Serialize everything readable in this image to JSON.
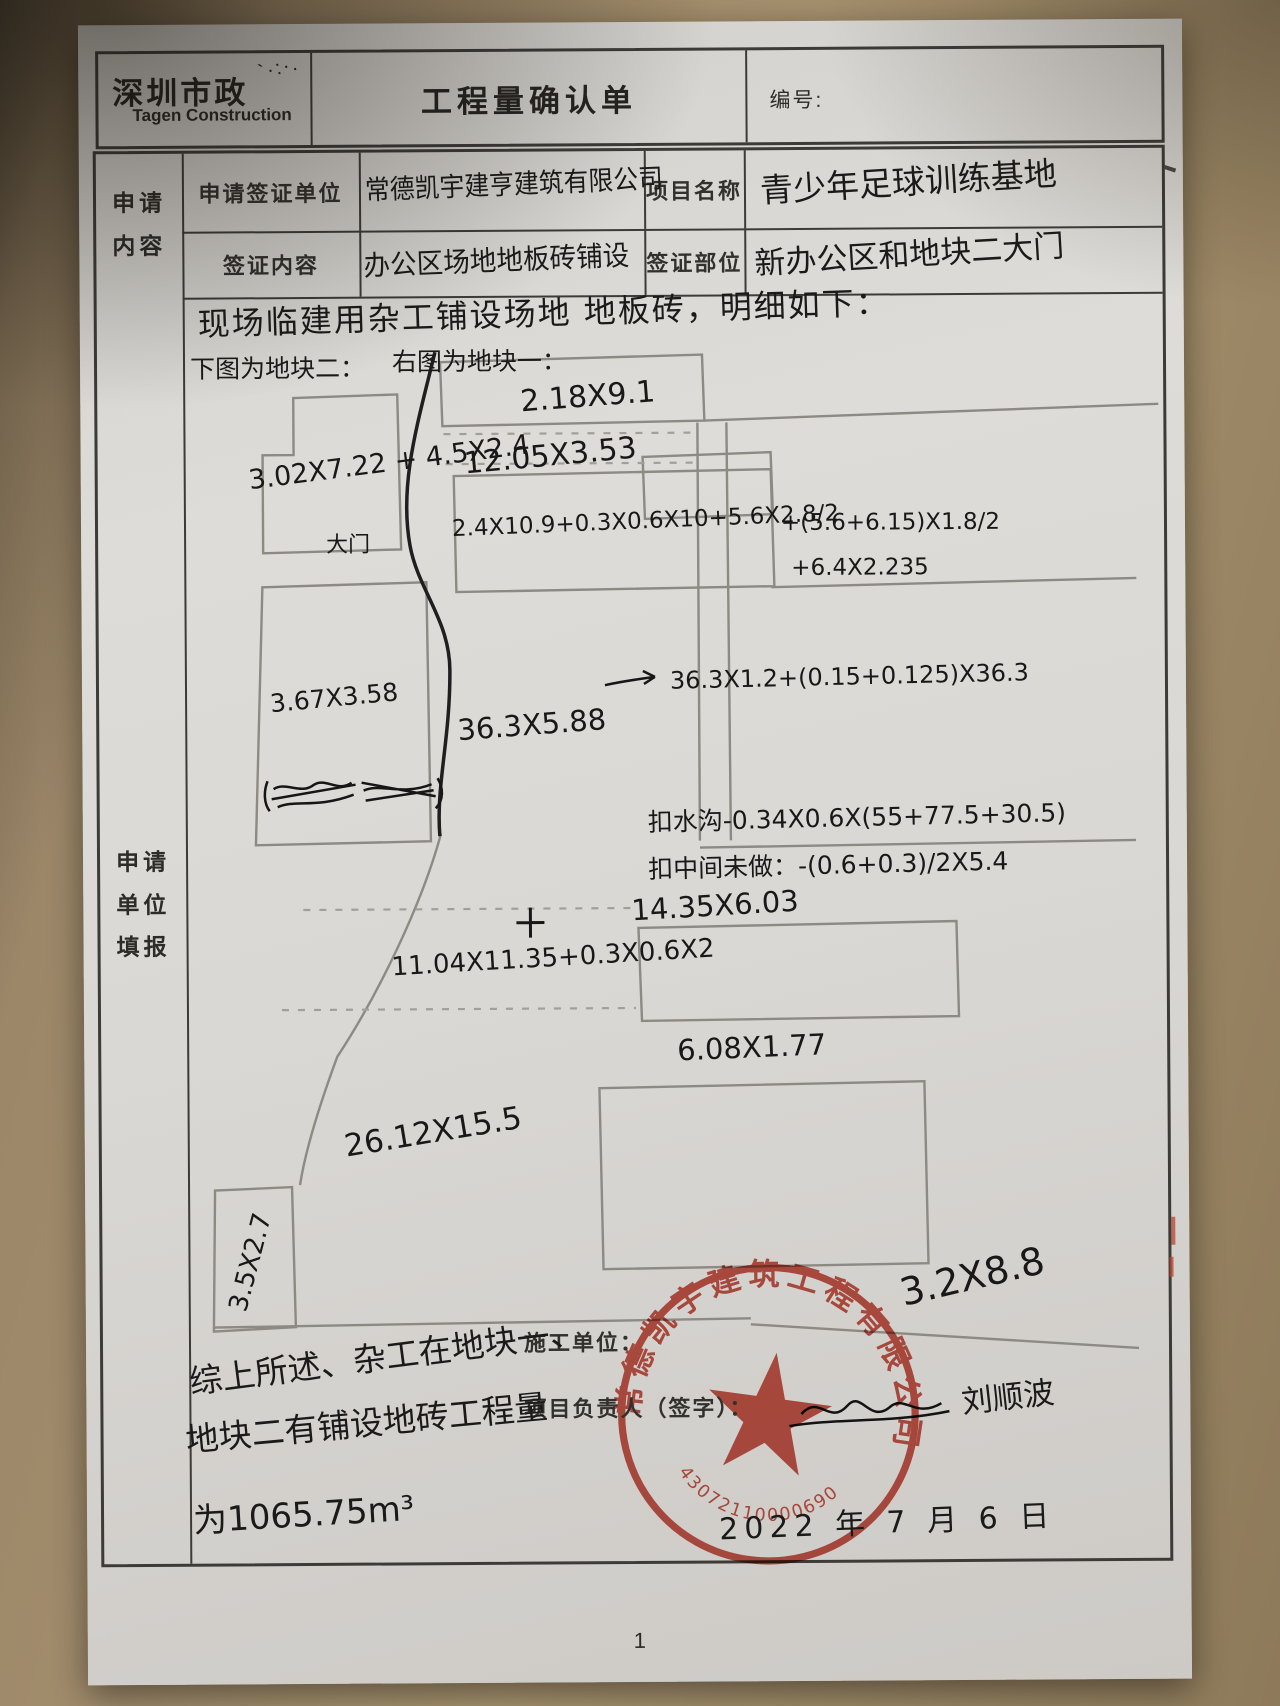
{
  "header": {
    "logo_cn": "深圳市政",
    "logo_en": "Tagen Construction",
    "title": "工程量确认单",
    "number_label": "编号:"
  },
  "form": {
    "apply_section_label": "申请内容",
    "fill_section_label": "申请单位填报",
    "apply_unit_label": "申请签证单位",
    "apply_unit_value": "常德凯宇建亨建筑有限公司",
    "project_name_label": "项目名称",
    "project_name_value": "青少年足球训练基地",
    "visa_content_label": "签证内容",
    "visa_content_value": "办公区场地地板砖铺设",
    "visa_location_label": "签证部位",
    "visa_location_value": "新办公区和地块二大门"
  },
  "notes": {
    "intro": "现场临建用杂工铺设场地 地板砖，明细如下：",
    "left_sketch_label": "下图为地块二：",
    "right_sketch_label": "右图为地块一："
  },
  "sketch": {
    "gate_label": "大门",
    "dims": {
      "block2_a": "3.02X7.22 + 4.5X2.4",
      "block2_b": "3.67X3.58",
      "block2_c": "3.5X2.7",
      "top": "2.18X9.1",
      "second": "12.05X3.53",
      "formula_main": "2.4X10.9+0.3X0.6X10+5.6X2.8/2",
      "formula_right": "+(5.6+6.15)X1.8/2",
      "formula_right2": "+6.4X2.235",
      "strip": "36.3X5.88",
      "strip_formula": "36.3X1.2+(0.15+0.125)X36.3",
      "deduct_ditch": "扣水沟-0.34X0.6X(55+77.5+30.5)",
      "deduct_middle": "扣中间未做：-(0.6+0.3)/2X5.4",
      "mid": "14.35X6.03",
      "mid_formula": "11.04X11.35+0.3X0.6X2",
      "lower": "6.08X1.77",
      "big": "26.12X15.5",
      "stamp_overlay": "3.2X8.8"
    }
  },
  "footer": {
    "contractor_label": "施工单位：",
    "manager_label": "项目负责人（签字）：",
    "signature": "刘顺波",
    "conclusion_line1": "综上所述、杂工在地块一、",
    "conclusion_line2": "地块二有铺设地砖工程量",
    "conclusion_line3": "为1065.75m³",
    "date": "2022 年 7 月 6 日",
    "page_number": "1"
  },
  "stamp": {
    "company": "常德凯宇建筑工程有限公司",
    "number": "43072110000690",
    "color": "#c0392b"
  }
}
